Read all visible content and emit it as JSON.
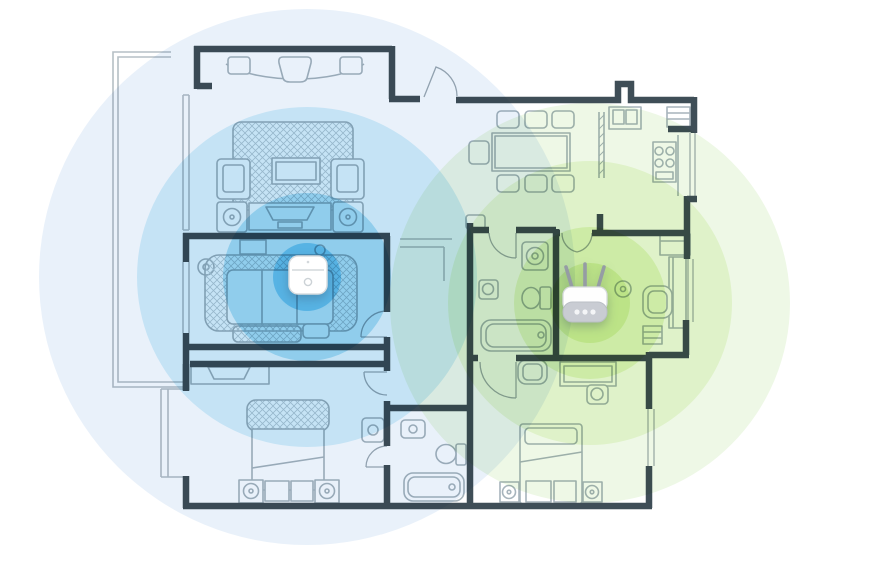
{
  "scene": {
    "type": "wifi-mesh-coverage-floorplan",
    "background": "#ffffff",
    "width": 891,
    "height": 562
  },
  "devices": {
    "extender": {
      "name": "wifi-mesh-extender",
      "x": 308,
      "y": 275
    },
    "router": {
      "name": "wifi-router",
      "x": 585,
      "y": 303
    }
  },
  "coverage": {
    "extender_rings": {
      "cx": 307,
      "cy": 277,
      "rings": [
        {
          "r": 268,
          "color": "#e9f1fa"
        },
        {
          "r": 170,
          "color": "#c5e3f5"
        },
        {
          "r": 84,
          "color": "#90cdec"
        },
        {
          "r": 34,
          "color": "#57b3e4"
        }
      ]
    },
    "router_rings": {
      "cx": 590,
      "cy": 303,
      "rings": [
        {
          "r": 200,
          "color": "#eef8e6"
        },
        {
          "r": 142,
          "color": "#dff2c9"
        },
        {
          "r": 76,
          "color": "#cdeba6"
        },
        {
          "r": 40,
          "color": "#bce387"
        }
      ]
    }
  },
  "palette": {
    "wall": "#3f4e57",
    "furniture": "#a7b4bc",
    "thin": "#b6bfc5",
    "door": "#9fabb3",
    "hatch": "#c3ced4",
    "device_body": "#ffffff",
    "device_edge": "#d9dde0",
    "router_base": "#c9ccd3",
    "antenna": "#959ca4"
  }
}
